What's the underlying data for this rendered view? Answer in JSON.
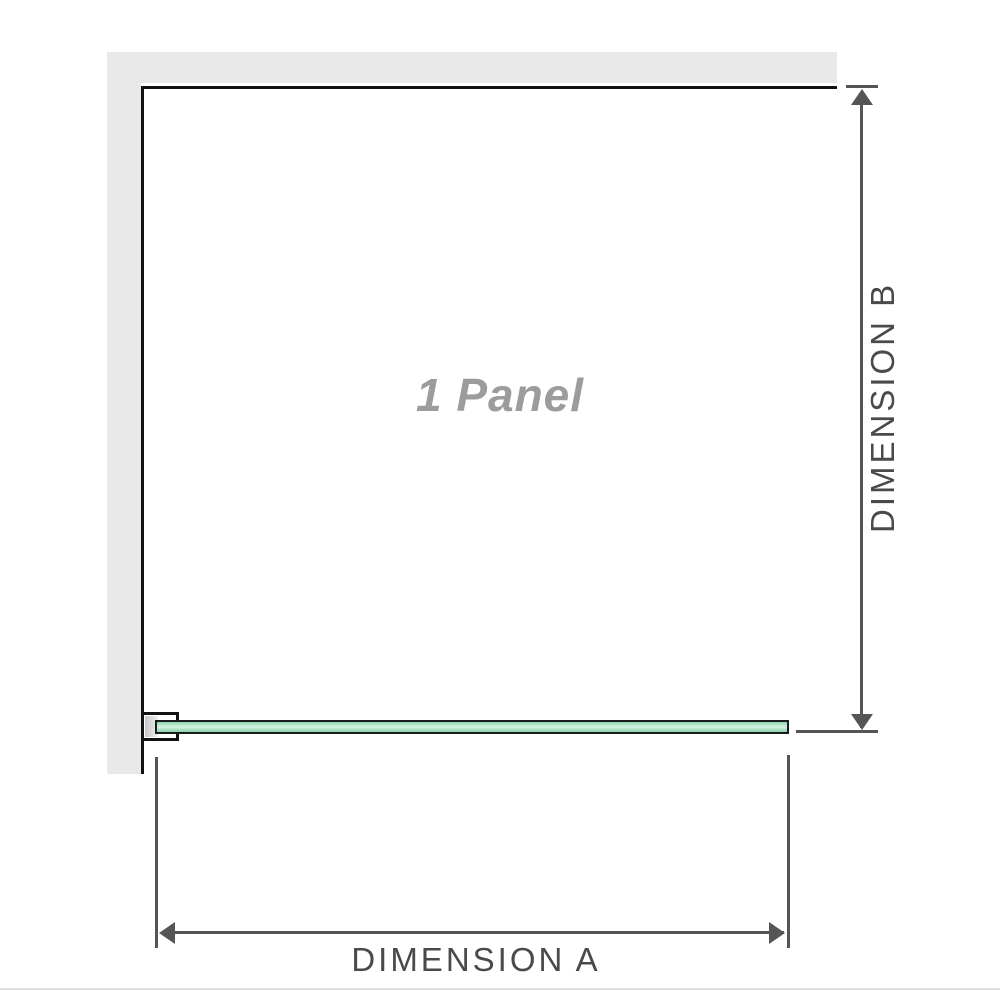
{
  "diagram": {
    "panel_label": "1 Panel",
    "dimensions": {
      "a_label": "DIMENSION A",
      "b_label": "DIMENSION B"
    },
    "colors": {
      "wall_fill": "#e9e9e9",
      "panel_outline": "#111111",
      "glass_fill": "#aee3c6",
      "glass_highlight": "#d9f3e4",
      "glass_border": "#1b1b1b",
      "bracket_pad": "#c6c6c6",
      "dimension_line": "#555555",
      "dimension_text": "#4a4a4a",
      "panel_text": "#9c9c9c",
      "bottom_hairline": "#dedede"
    }
  }
}
